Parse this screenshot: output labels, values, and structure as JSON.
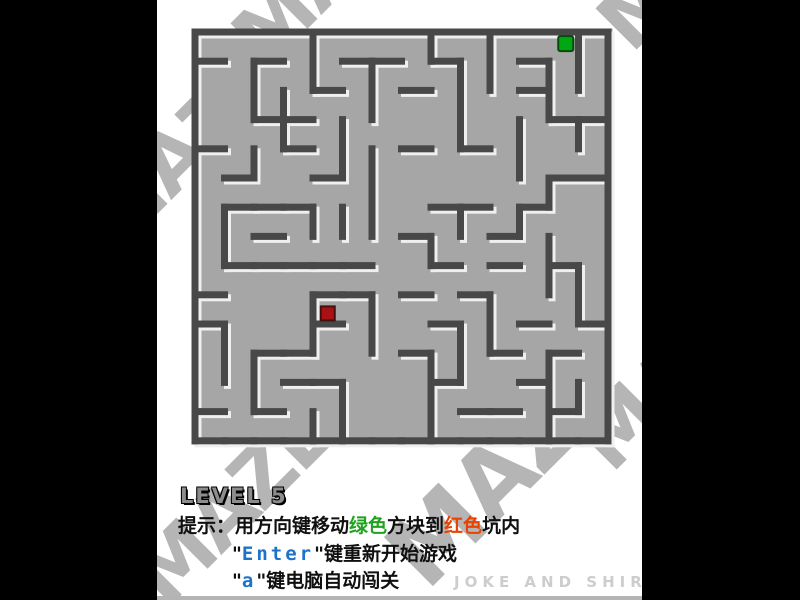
{
  "window": {
    "side_bar_color": "#000000",
    "panel_bg": "#ffffff",
    "bottom_strip_color": "#b4b4b4"
  },
  "maze": {
    "rows": 14,
    "cols": 14,
    "floor_color": "#a6a6a6",
    "wall_color": "#484848",
    "highlight_color": "#efefef",
    "h_walls": [
      "11111111111111",
      "10100110100100",
      "00001001000100",
      "00110000000011",
      "10010001010000",
      "01001000000011",
      "01110000110100",
      "00100001001000",
      "01111100101010",
      "10001101010000",
      "10001000100101",
      "00110001001010",
      "00011000100100",
      "10100000011010",
      "11111111111111"
    ],
    "v_walls": [
      "100010001010011",
      "101010100110111",
      "101100100100101",
      "100101000101011",
      "101001100001001",
      "100000100000101",
      "110011100101001",
      "110000001000101",
      "100000000000111",
      "100010100010011",
      "110010100110001",
      "111000001100101",
      "101001001000111",
      "100011001000101"
    ],
    "player": {
      "name": "green-block",
      "color": "#00a713",
      "border": "#054d0a",
      "col": 12,
      "row": 0
    },
    "target": {
      "name": "red-pit",
      "color": "#ab1112",
      "border": "#431010",
      "col": 4,
      "row": 9
    }
  },
  "hud": {
    "level_label": "LEVEL 5",
    "hint": {
      "prefix": "提示：用方向键移动",
      "green_word": "绿色",
      "mid": "方块到",
      "red_word": "红色",
      "suffix": "坑内"
    },
    "enter_line": {
      "quote_open": "\"",
      "key": "Enter",
      "quote_close": "\"",
      "rest": "键重新开始游戏"
    },
    "auto_line": {
      "quote_open": "\"",
      "key": "a",
      "quote_close": "\"",
      "rest": "键电脑自动闯关"
    },
    "credit": "JOKE AND SHIRLEY",
    "colors": {
      "green": "#1fa31f",
      "red": "#e84300",
      "blue": "#1d72cc",
      "level_fill": "#8c8c8c"
    }
  },
  "watermark": {
    "text": "MAZE",
    "color": "#b5b5b5",
    "positions": [
      {
        "left": 55,
        "top": -75,
        "size": 80
      },
      {
        "left": 420,
        "top": -90,
        "size": 80
      },
      {
        "left": -95,
        "top": 110,
        "size": 80
      },
      {
        "left": 400,
        "top": 330,
        "size": 80
      },
      {
        "left": -45,
        "top": 465,
        "size": 80
      },
      {
        "left": 205,
        "top": 420,
        "size": 95
      }
    ]
  }
}
